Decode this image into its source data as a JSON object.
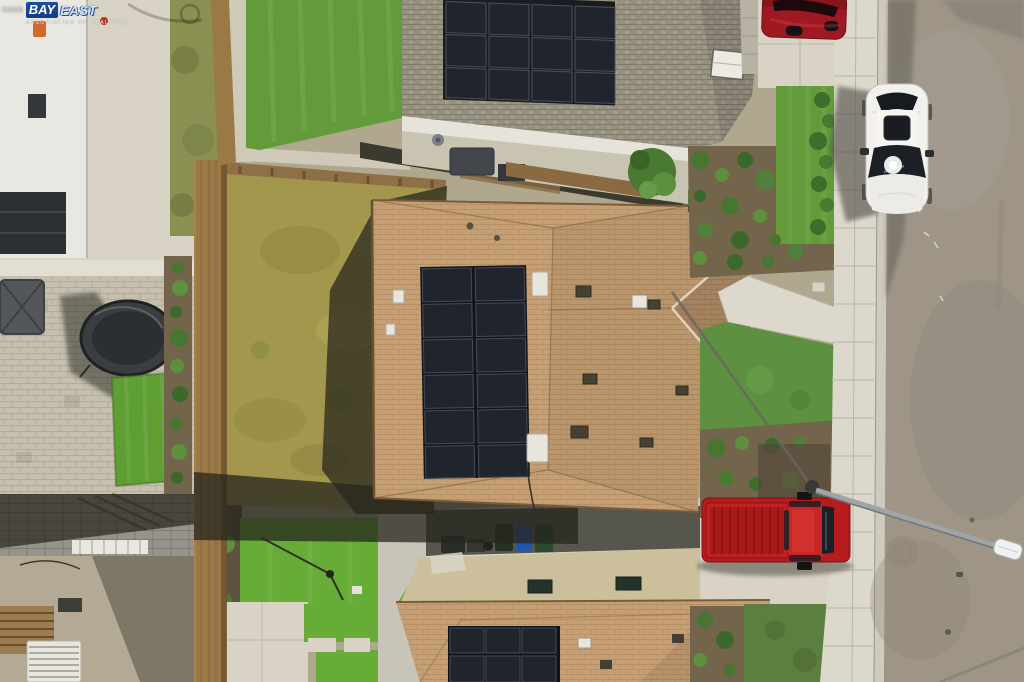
{
  "watermark": {
    "copyright": "©2020",
    "brand_bay": "BAY",
    "brand_east": "EAST",
    "subtitle": "ASSOCIATION OF REALTORS"
  },
  "scene": {
    "description": "Overhead aerial drone photo of a two-story house with rooftop solar panels, neighboring homes, backyards, sidewalk and street with parked vehicles",
    "palette": {
      "street": "#9e9587",
      "sidewalk": "#dcd8cc",
      "curb": "#cfcabe",
      "concrete": "#d8d3c5",
      "roof_tan": "#c6a074",
      "roof_gray": "#96907f",
      "roof_khaki": "#ccc09c",
      "solar": "#20242c",
      "lawn": "#639b3a",
      "lawn_front": "#5d9141",
      "turf": "#67ac36",
      "turf_left": "#5f9e33",
      "dry_grass": "#a3974d",
      "pavers": "#c6bfae",
      "fence": "#9a7946",
      "mulch": "#73654c",
      "white_house": "#e9e7e1",
      "awning": "#e6e3da",
      "wall_gray": "#96938a",
      "car_white": "#f2f1ed",
      "truck_red": "#b61b1e",
      "suv_red": "#a01822",
      "watermark_blue": "#1c4f9f"
    },
    "objects": {
      "left_patio": "Neighboring backyard with paver patio",
      "trampoline": "Trampoline with safety net",
      "left_turf": "Artificial turf strip in paver patio",
      "bottom_left_yard": "Neighboring yard with block wall, pergola and patio",
      "green_yard": "Backyard with bright artificial turf and concrete patio",
      "backyard": "Fenced backyard with dry patchy lawn",
      "main_house": "Main house with tan shingle hip roof",
      "main_solar": "Rooftop solar panel array, 2 columns by 6 rows",
      "top_house": "Neighboring house with gray shingle roof and large solar array",
      "bottom_house": "Neighboring house roof with solar panels and side yard",
      "bins": "Three wheeled trash bins against wall",
      "front_yard": "Front yard with shrubs, lawn and walkway",
      "sidewalk": "Concrete sidewalk with expansion joints",
      "street": "Asphalt street",
      "white_car": "White sedan parked at the curb",
      "red_suv": "Red SUV parked in upper driveway",
      "red_truck": "Red pickup truck parked in lower driveway",
      "streetlight": "Streetlight mast arm extending over the road",
      "watermark": "Bay East Association of Realtors watermark"
    }
  }
}
